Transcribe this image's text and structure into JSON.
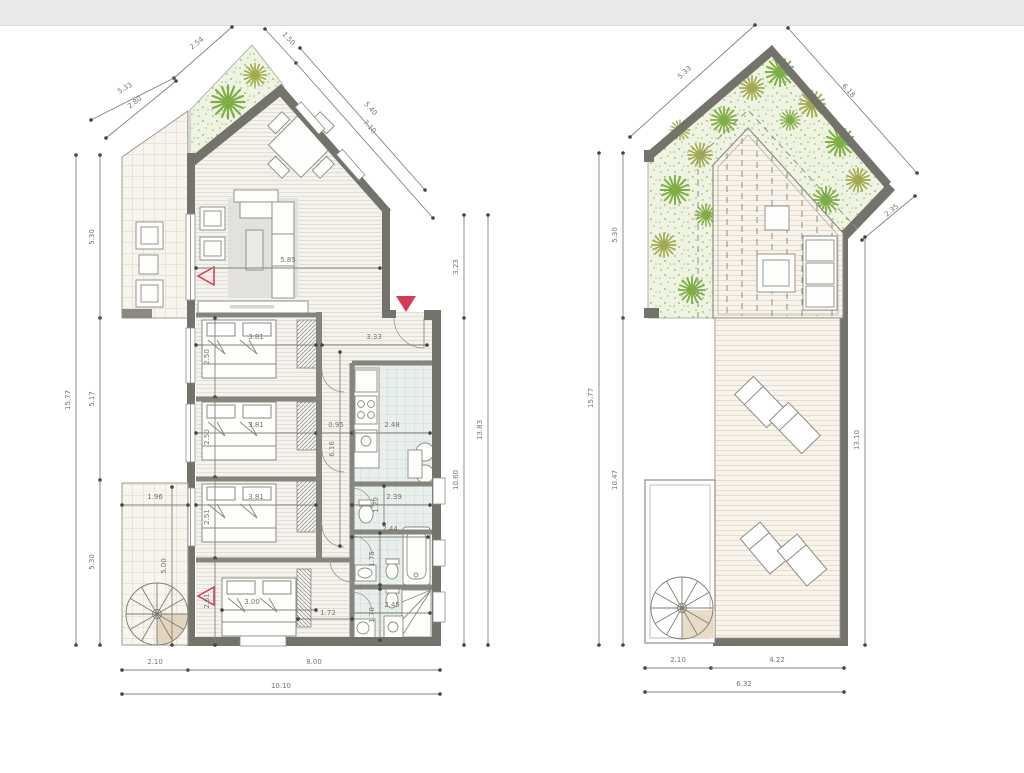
{
  "window": {
    "topbar_color": "#e9e9e7",
    "canvas_color": "#ffffff"
  },
  "drawing": {
    "type": "architectural floor plan, two levels",
    "accent_red": "#d93954",
    "wall_color": "#73736c",
    "greenery_color": "#8db852",
    "left_plan": {
      "diag_tl": [
        "5.33",
        "2.54"
      ],
      "diag_tl_inner": "2.80",
      "diag_tr": [
        "1.50",
        "7.10"
      ],
      "diag_tr_inner": "5.40",
      "side_left_total": "15.77",
      "side_left": [
        "5.30",
        "5.17",
        "5.30"
      ],
      "side_right": [
        "3.23",
        "10.60"
      ],
      "side_right_total": "13.83",
      "bottom": [
        "2.10",
        "8.00"
      ],
      "bottom_total": "10.10",
      "living_width": "5.85",
      "hall_width": "3.33",
      "bed1": {
        "w": "3.81",
        "h": "2.50"
      },
      "bed2": {
        "w": "3.81",
        "h": "2.50"
      },
      "bed3": {
        "w": "3.81",
        "h": "2.51"
      },
      "bed4": {
        "w": "3.00",
        "h": "2.61"
      },
      "corridor": {
        "w": "0.95",
        "l": "6.16"
      },
      "kitchen_w": "2.48",
      "wc": {
        "w": "2.39",
        "h": "1.20"
      },
      "bath": {
        "w": "2.44",
        "h": "1.75"
      },
      "shower": {
        "w": "2.45",
        "h": "1.70"
      },
      "closet_w": "1.72",
      "terrace": {
        "w": "1.96",
        "h": "5.00"
      }
    },
    "right_plan": {
      "diag_tl": "5.33",
      "diag_tr": "6.18",
      "diag_r": "2.35",
      "side_left_total": "15.77",
      "side_left": [
        "5.30",
        "10.47"
      ],
      "side_right": "13.10",
      "bottom": [
        "2.10",
        "4.22"
      ],
      "bottom_total": "6.32"
    }
  }
}
